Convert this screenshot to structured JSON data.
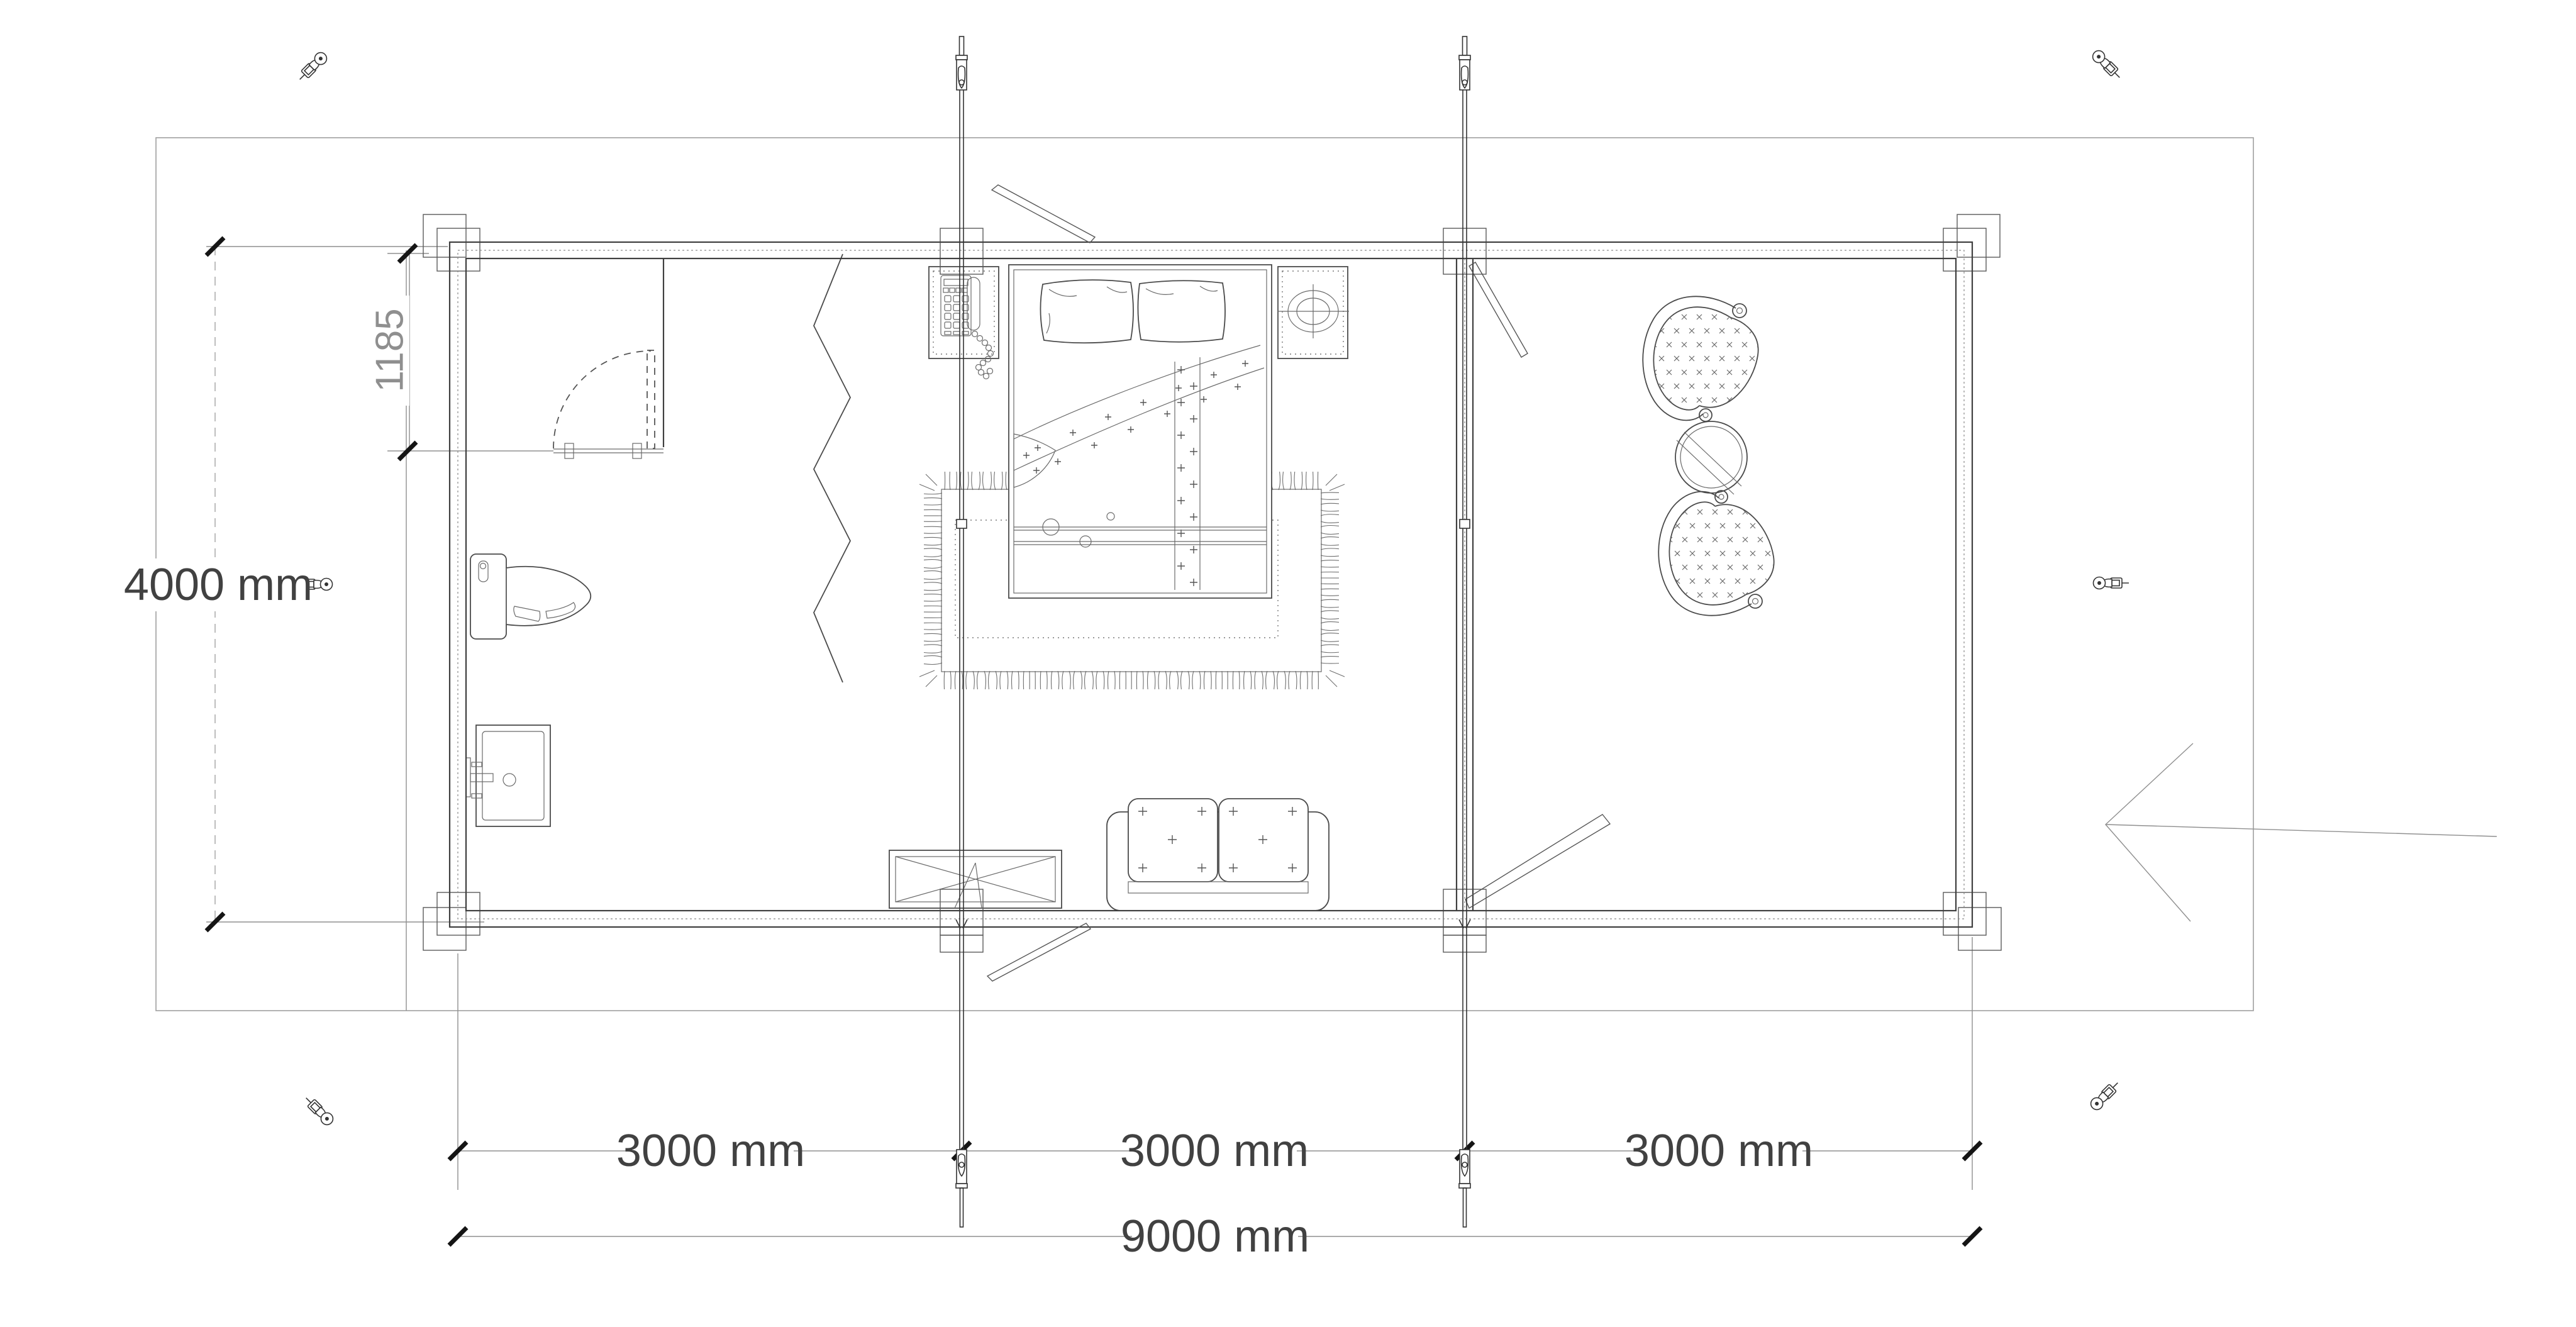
{
  "drawing": {
    "type": "floor-plan",
    "building": "log cabin 9000 x 4000 mm, two rooms with sauna/bath corner",
    "dimensions": {
      "left_height_label": "4000 mm",
      "door_offset_label": "1185",
      "module_labels": [
        "3000 mm",
        "3000 mm",
        "3000 mm"
      ],
      "total_width_label": "9000 mm"
    },
    "icons": [
      "anchor-bolt-icon-top-left",
      "anchor-bolt-icon-top-right",
      "anchor-bolt-icon-mid-left",
      "anchor-bolt-icon-mid-right",
      "anchor-bolt-icon-bottom-left",
      "anchor-bolt-icon-bottom-right",
      "storm-rod-icon-left",
      "storm-rod-icon-right",
      "entrance-arrow-icon"
    ],
    "furniture": [
      "double-bed",
      "pillow-left",
      "pillow-right",
      "blanket",
      "nightstand-with-phone",
      "nightstand-with-lamp",
      "rug",
      "storage-chest",
      "sofa",
      "toilet",
      "washbasin",
      "zigzag-divider",
      "tub-chair-upper",
      "tub-chair-lower",
      "round-table",
      "bath-door"
    ],
    "colors": {
      "background": "#ffffff",
      "wall_line": "#3f3f3f",
      "dimension_line": "#8f8f8f",
      "text_dark": "#414141",
      "text_light": "#8f8f8f",
      "boundary": "#9f9f9f",
      "tick": "#151515"
    }
  }
}
